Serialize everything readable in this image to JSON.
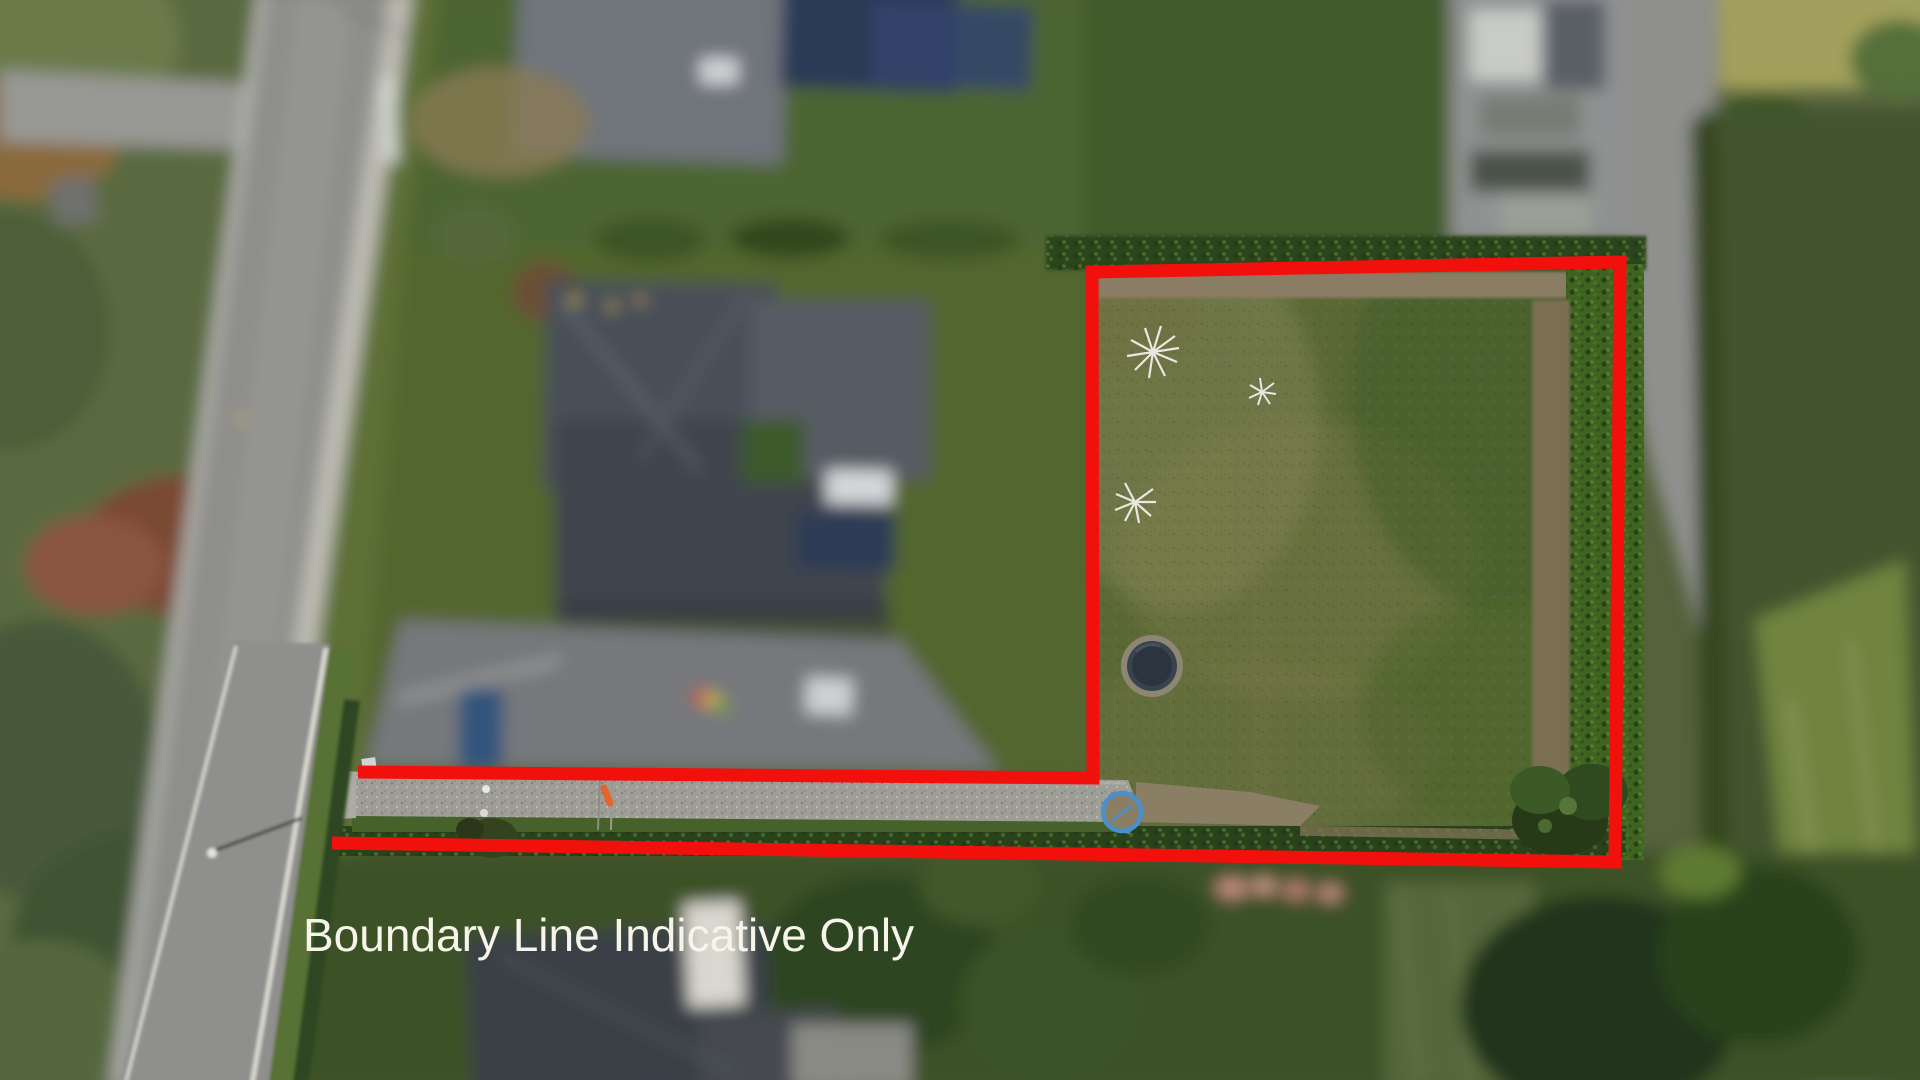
{
  "overlay": {
    "caption": "Boundary Line Indicative Only",
    "caption_color": "#f7f5ea",
    "caption_font_px": 46,
    "boundary": {
      "color": "#f2100d",
      "stroke_width": 13,
      "points": "358,772 1093,778 1092,272 1620,262 1615,862 332,843",
      "shape": "open flag-shaped lot: large rear square plus narrow driveway strip to road"
    }
  },
  "scene": {
    "type": "aerial-drone-photo",
    "subject": "residential section; surroundings defocused, boundary area in focus",
    "colors": {
      "lawn_base": "#5a6836",
      "lawn_dry_patch": "#8f8b60",
      "lawn_rich": "#3f5c28",
      "neighbor_lawn": "#3f5a2b",
      "hedge_dark": "#2c451b",
      "hedge_bright": "#3e6420",
      "dirt_path": "#8b7d63",
      "gravel_driveway": "#9e9e96",
      "road": "#8e8e8c",
      "kerb": "#d9d8d0",
      "footpath": "#bdbcb2",
      "grass_verge": "#5d7036",
      "roof_main": "#4a4f58",
      "roof_neighbor": "#3b4046",
      "solar_panel": "#2c3b56",
      "skylight_white": "#d4d7d9",
      "pond_rim": "#8c8673",
      "pond_water": "#2c343f",
      "car_blue": "#33557d",
      "hose_ring_blue": "#4a8fd0",
      "flag_orange": "#e8622e",
      "flower_pink": "#c38d80",
      "dry_field": "#a2a05c"
    },
    "features": [
      "street running diagonally along left edge",
      "cross street at top left",
      "main dwelling with grey hip roof and solar panels (blurred)",
      "gravel driveway strip inside boundary",
      "large fenced rear lawn inside boundary",
      "circular stone-rimmed pond in lawn",
      "three white leafless saplings in lawn",
      "blue hose ring at end of driveway",
      "hedges along boundary lines",
      "neighbouring roofs and gardens defocused"
    ]
  }
}
